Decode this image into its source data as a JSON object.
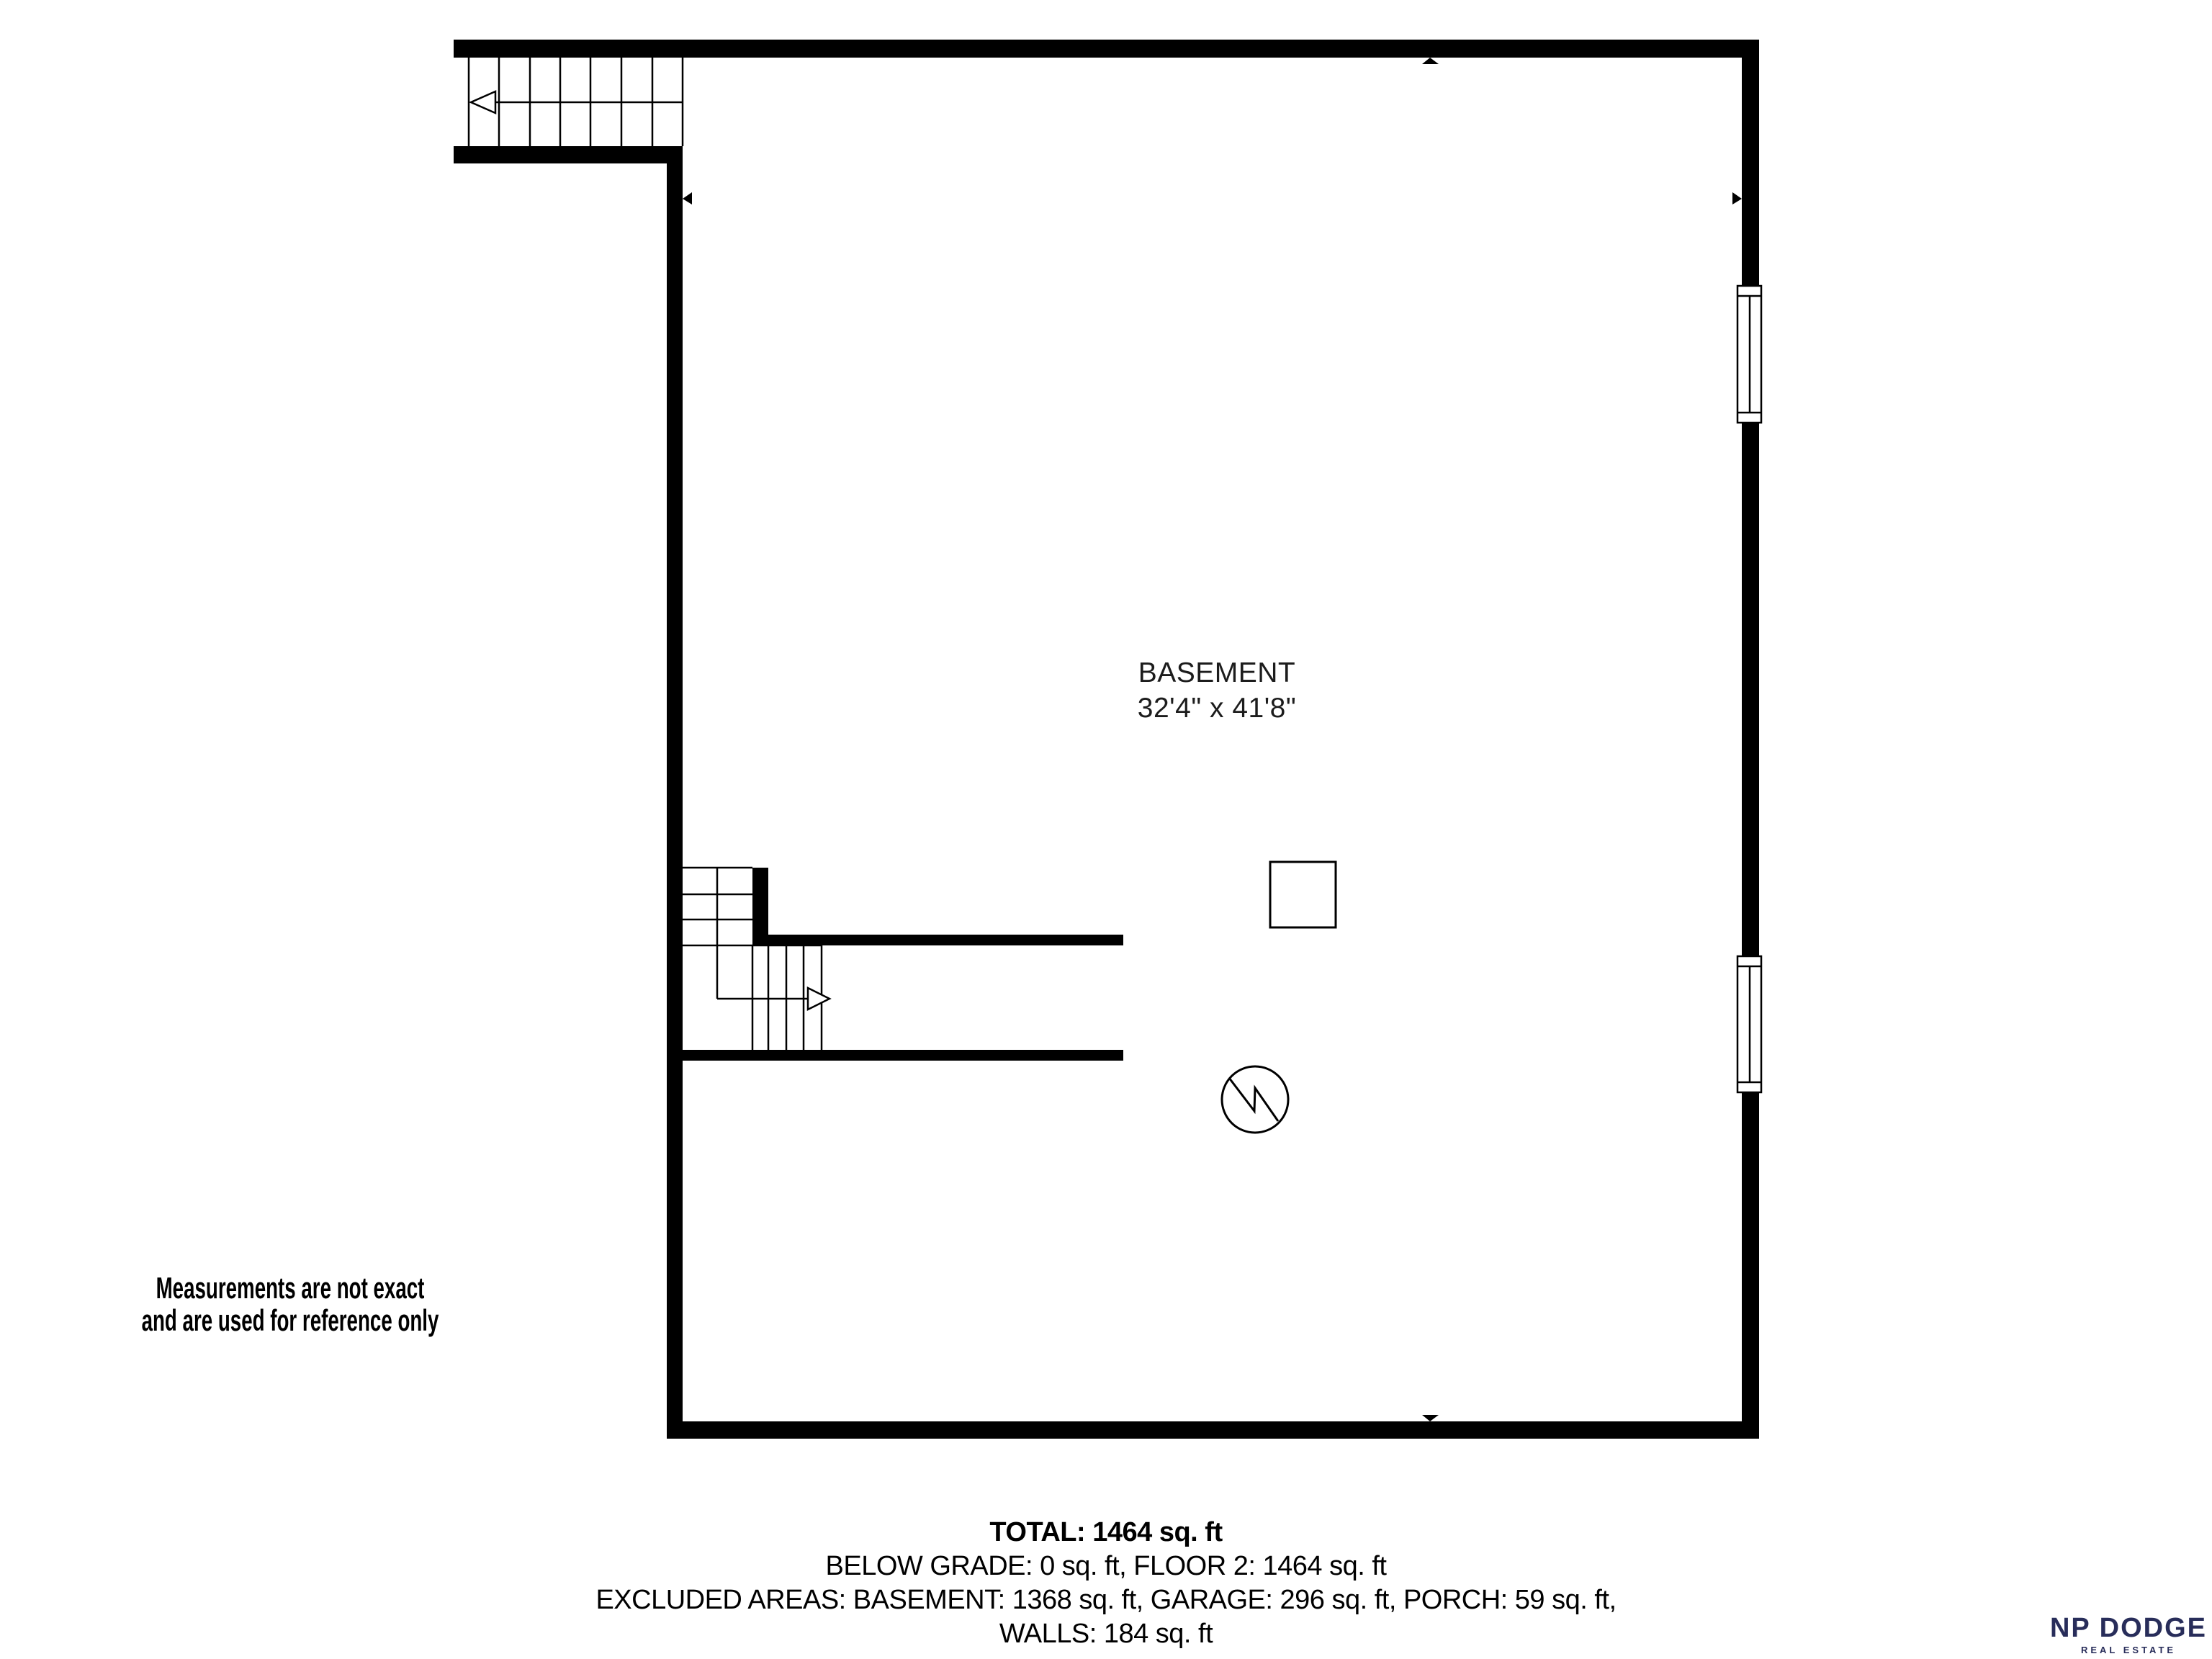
{
  "floorplan": {
    "room": {
      "name": "BASEMENT",
      "dimensions": "32'4\" x 41'8\""
    },
    "colors": {
      "walls": "#000000",
      "background": "#ffffff",
      "thin_lines": "#000000"
    },
    "symbols": {
      "upper_staircase_icon": "stairs-arrow-left",
      "interior_staircase_icon": "stairs-turn-arrow-right",
      "post_icon": "square-post",
      "utility_icon": "circle-with-zigzag",
      "window_count": 2,
      "wall_direction_markers": 4
    }
  },
  "disclaimer": {
    "line1": "Measurements are not exact",
    "line2": "and are used for reference only"
  },
  "summary": {
    "total": "TOTAL: 1464 sq. ft",
    "below_grade": "BELOW GRADE: 0 sq. ft, FLOOR 2: 1464 sq. ft",
    "excluded_areas": "EXCLUDED AREAS: BASEMENT: 1368 sq. ft, GARAGE: 296 sq. ft, PORCH: 59 sq. ft,",
    "walls": "WALLS: 184 sq. ft"
  },
  "branding": {
    "name": "NP DODGE",
    "tagline": "REAL ESTATE",
    "color": "#282d5a"
  }
}
